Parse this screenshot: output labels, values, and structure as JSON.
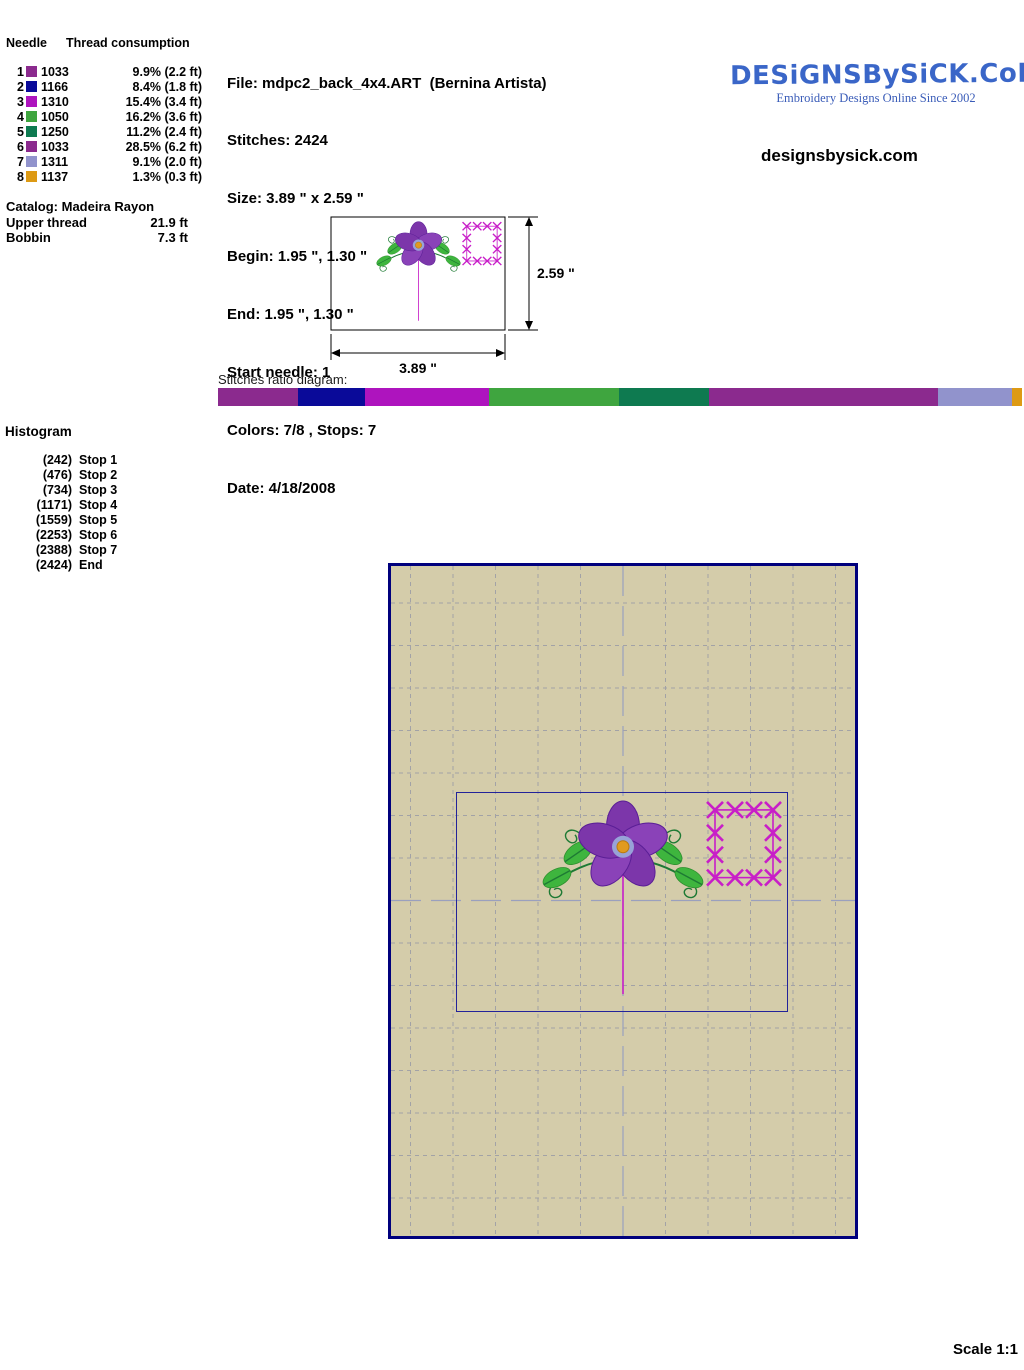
{
  "needle_table": {
    "col_needle": "Needle",
    "col_consumption": "Thread consumption",
    "rows": [
      {
        "needle": "1",
        "code": "1033",
        "usage": "9.9% (2.2 ft)",
        "color": "#8B2A8E"
      },
      {
        "needle": "2",
        "code": "1166",
        "usage": "8.4% (1.8 ft)",
        "color": "#0A0A99"
      },
      {
        "needle": "3",
        "code": "1310",
        "usage": "15.4% (3.4 ft)",
        "color": "#AE14BE"
      },
      {
        "needle": "4",
        "code": "1050",
        "usage": "16.2% (3.6 ft)",
        "color": "#3FA53F"
      },
      {
        "needle": "5",
        "code": "1250",
        "usage": "11.2% (2.4 ft)",
        "color": "#0E7A50"
      },
      {
        "needle": "6",
        "code": "1033",
        "usage": "28.5% (6.2 ft)",
        "color": "#8B2A8E"
      },
      {
        "needle": "7",
        "code": "1311",
        "usage": "9.1% (2.0 ft)",
        "color": "#9193CC"
      },
      {
        "needle": "8",
        "code": "1137",
        "usage": "1.3% (0.3 ft)",
        "color": "#DD9A14"
      }
    ]
  },
  "catalog": {
    "title": "Catalog: Madeira Rayon",
    "upper_label": "Upper thread",
    "upper_value": "21.9 ft",
    "bobbin_label": "Bobbin",
    "bobbin_value": "7.3 ft"
  },
  "file_info": {
    "file": "File: mdpc2_back_4x4.ART  (Bernina Artista)",
    "stitches": "Stitches: 2424",
    "size": "Size: 3.89 \" x 2.59 \"",
    "begin": "Begin: 1.95 \", 1.30 \"",
    "end": "End: 1.95 \", 1.30 \"",
    "start_needle": "Start needle: 1",
    "colors_stops": "Colors: 7/8 , Stops: 7",
    "date": "Date: 4/18/2008"
  },
  "brand": {
    "logo": "DESiGNSBySiCK.CoM",
    "tagline": "Embroidery Designs Online Since 2002",
    "site": "designsbysick.com",
    "logo_color": "#3A66C8"
  },
  "preview": {
    "width_label": "3.89 \"",
    "height_label": "2.59 \""
  },
  "ratio": {
    "label": "Stitches ratio diagram:",
    "segments": [
      {
        "percent": 9.9,
        "color": "#8B2A8E"
      },
      {
        "percent": 8.4,
        "color": "#0A0A99"
      },
      {
        "percent": 15.4,
        "color": "#AE14BE"
      },
      {
        "percent": 16.2,
        "color": "#3FA53F"
      },
      {
        "percent": 11.2,
        "color": "#0E7A50"
      },
      {
        "percent": 28.5,
        "color": "#8B2A8E"
      },
      {
        "percent": 9.1,
        "color": "#9193CC"
      },
      {
        "percent": 1.3,
        "color": "#DD9A14"
      }
    ]
  },
  "histogram": {
    "title": "Histogram",
    "rows": [
      {
        "count": "(242)",
        "label": "Stop 1"
      },
      {
        "count": "(476)",
        "label": "Stop 2"
      },
      {
        "count": "(734)",
        "label": "Stop 3"
      },
      {
        "count": "(1171)",
        "label": "Stop 4"
      },
      {
        "count": "(1559)",
        "label": "Stop 5"
      },
      {
        "count": "(2253)",
        "label": "Stop 6"
      },
      {
        "count": "(2388)",
        "label": "Stop 7"
      },
      {
        "count": "(2424)",
        "label": "End"
      }
    ]
  },
  "page": {
    "scale_label": "Scale 1:1"
  }
}
